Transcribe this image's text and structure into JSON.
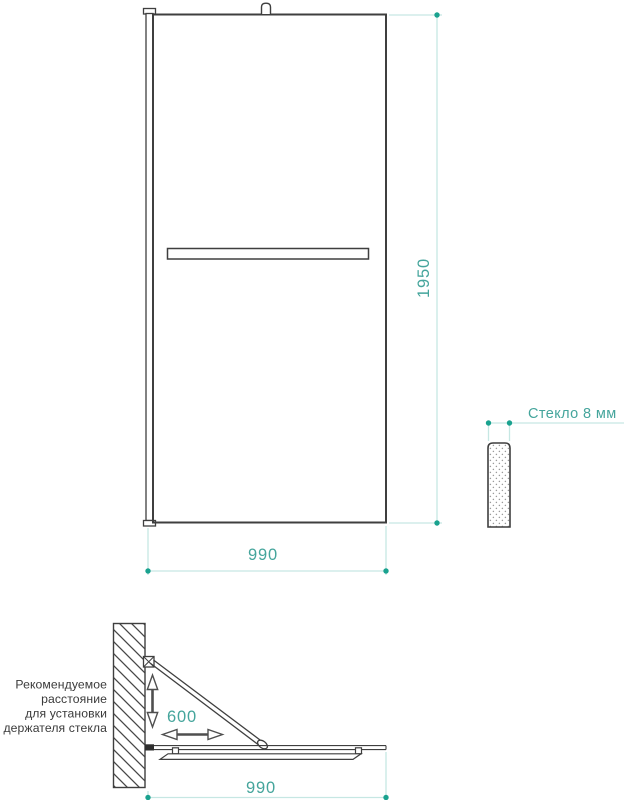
{
  "colors": {
    "accent_text": "#45a59c",
    "accent_dot": "#1aa28f",
    "dim_line": "#c6e7e3",
    "drawing_stroke": "#3f3f3f",
    "note_text": "#3a3a3a",
    "arrow_gray": "#4f4f4f"
  },
  "front_view": {
    "height_dim": "1950",
    "width_dim": "990"
  },
  "thickness_view": {
    "label": "Стекло 8 мм"
  },
  "plan_view": {
    "holder_distance_dim": "600",
    "width_dim": "990",
    "note_lines": [
      "Рекомендуемое",
      "расстояние",
      "для установки",
      "держателя стекла"
    ]
  }
}
